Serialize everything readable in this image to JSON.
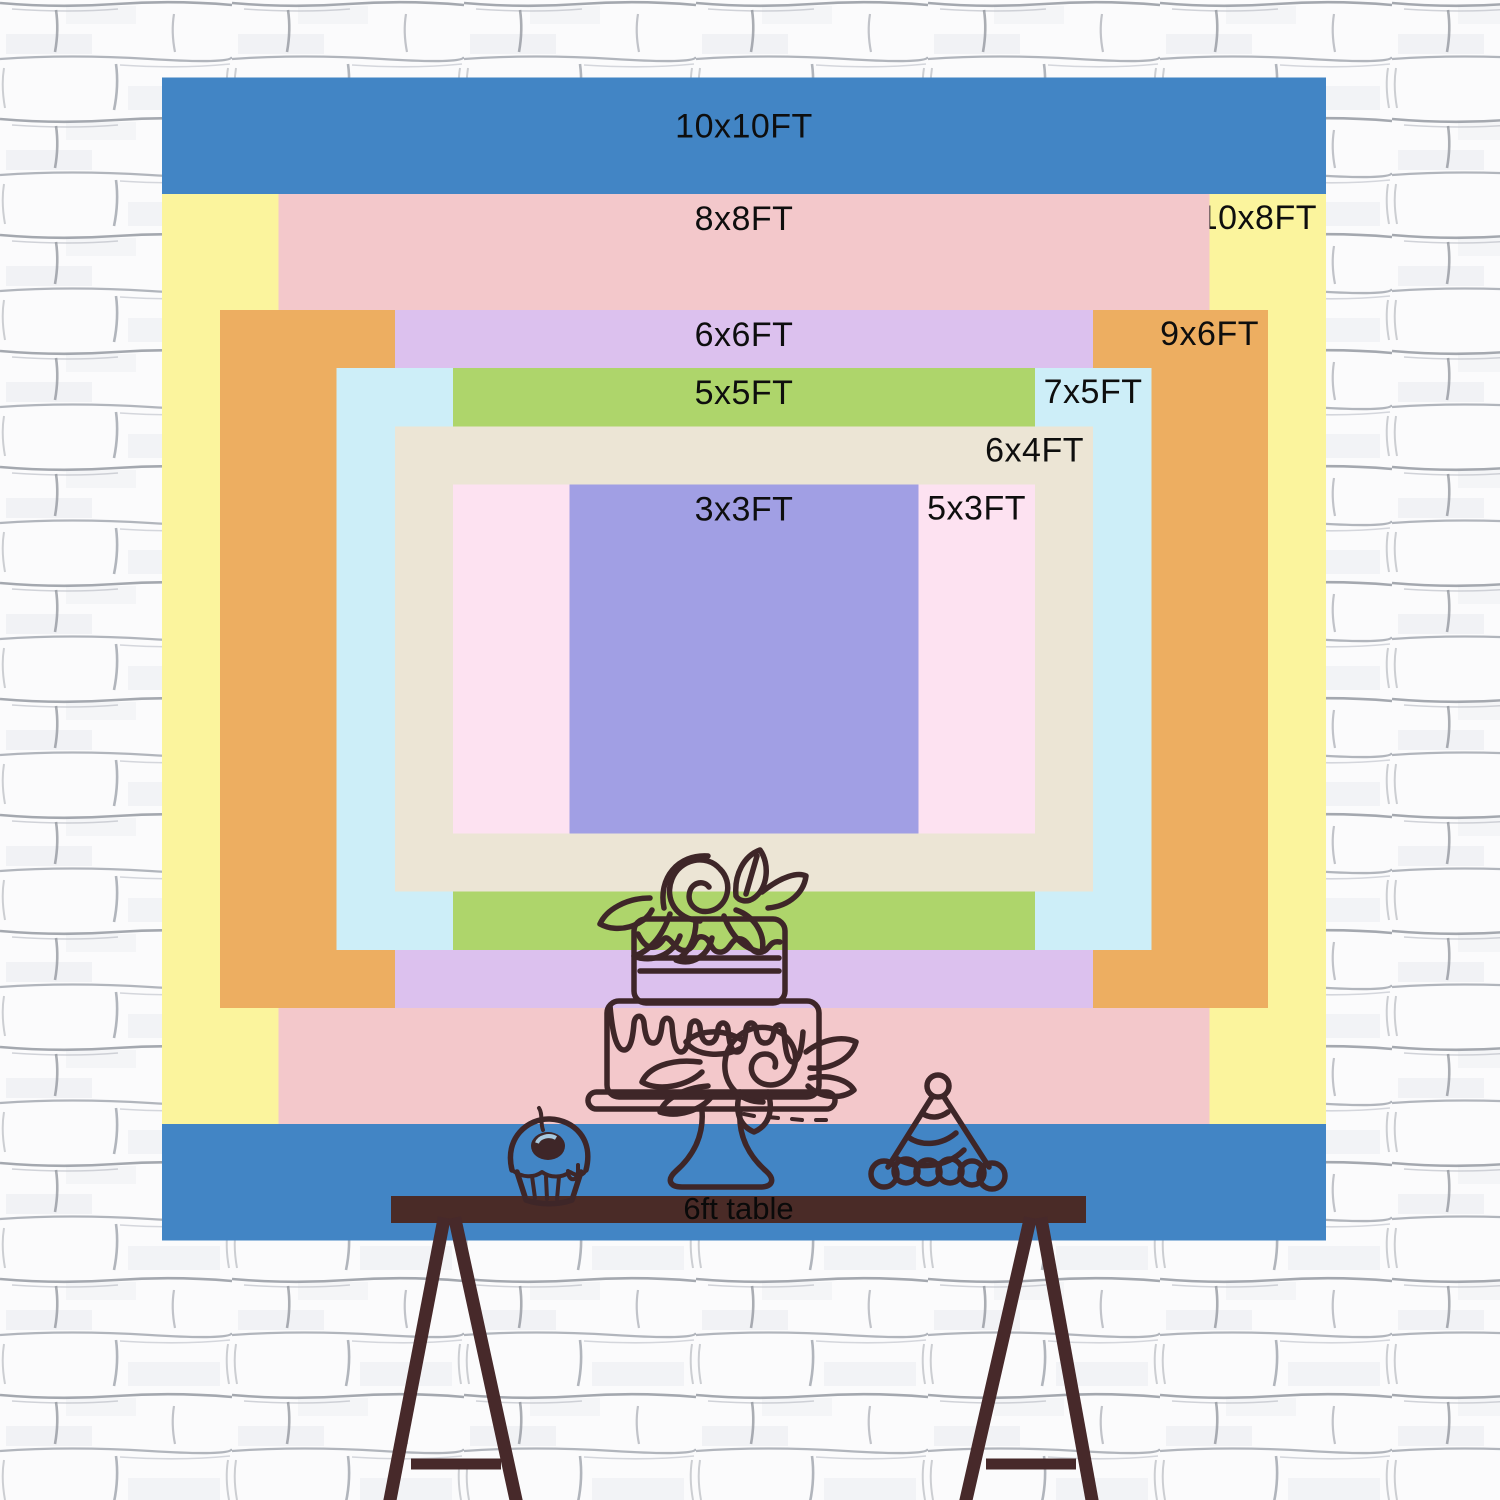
{
  "backdrop": {
    "unit": "FT",
    "sizes": [
      {
        "label": "10x10FT",
        "width_ft": 10,
        "height_ft": 10,
        "color": "#4285c5",
        "label_side": "center"
      },
      {
        "label": "10x8FT",
        "width_ft": 10,
        "height_ft": 8,
        "color": "#fbf49d",
        "label_side": "right"
      },
      {
        "label": "8x8FT",
        "width_ft": 8,
        "height_ft": 8,
        "color": "#f3c8cb",
        "label_side": "center"
      },
      {
        "label": "9x6FT",
        "width_ft": 9,
        "height_ft": 6,
        "color": "#edae61",
        "label_side": "right"
      },
      {
        "label": "6x6FT",
        "width_ft": 6,
        "height_ft": 6,
        "color": "#dcc1ee",
        "label_side": "center"
      },
      {
        "label": "7x5FT",
        "width_ft": 7,
        "height_ft": 5,
        "color": "#cdeef8",
        "label_side": "right"
      },
      {
        "label": "5x5FT",
        "width_ft": 5,
        "height_ft": 5,
        "color": "#aed56b",
        "label_side": "center"
      },
      {
        "label": "6x4FT",
        "width_ft": 6,
        "height_ft": 4,
        "color": "#ece5d5",
        "label_side": "right"
      },
      {
        "label": "5x3FT",
        "width_ft": 5,
        "height_ft": 3,
        "color": "#fde2f1",
        "label_side": "right"
      },
      {
        "label": "3x3FT",
        "width_ft": 3,
        "height_ft": 3,
        "color": "#a19fe4",
        "label_side": "center"
      }
    ]
  },
  "table": {
    "label": "6ft table"
  },
  "decorations": {
    "items": [
      "cupcake-icon",
      "tiered-cake-icon",
      "party-hat-icon"
    ]
  },
  "colors": {
    "label_text": "#0e0e0e",
    "table_wood": "#4a2b27",
    "line_art": "#3e2628",
    "wall": "#fbfbfc"
  }
}
